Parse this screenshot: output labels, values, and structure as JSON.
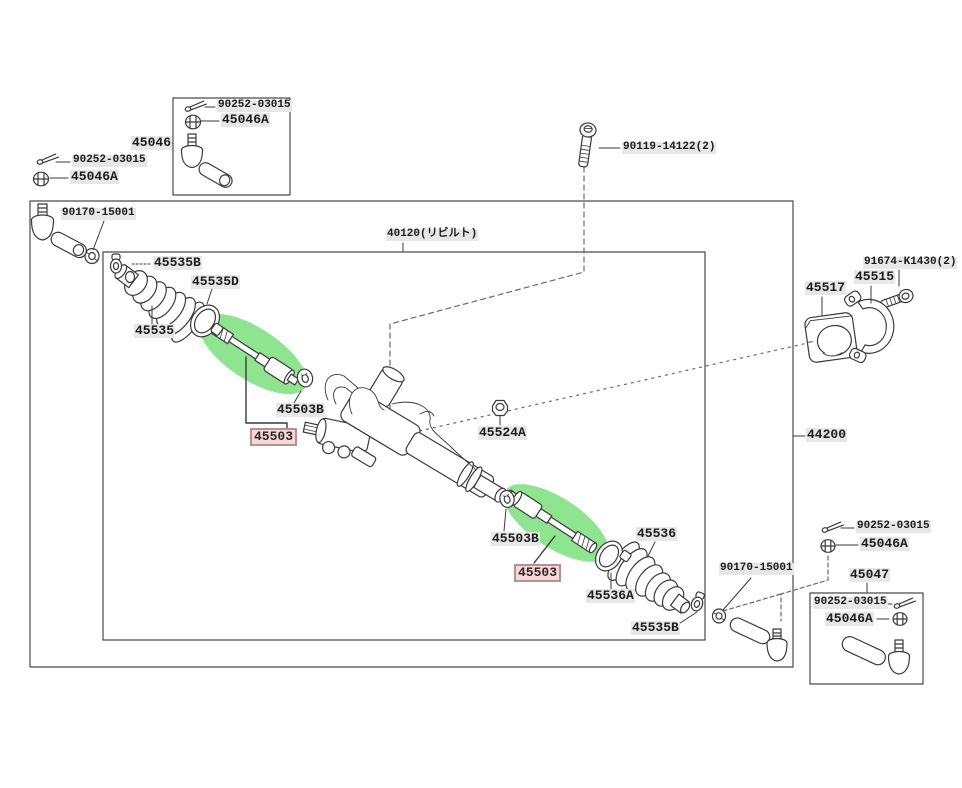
{
  "diagram": {
    "type": "exploded-parts-diagram",
    "subject": "steering gear and linkage",
    "highlight_color": "#8fe48f",
    "highlight_label_bg": "#f3d9d9",
    "highlight_label_border": "#b99090",
    "labels": {
      "tl_pin": "90252-03015",
      "tl_nut": "45046A",
      "t45046": "45046",
      "b46_pin": "90252-03015",
      "b46_nut": "45046A",
      "bolt90119": "90119-14122(2)",
      "nut_left": "90170-15001",
      "rack40120": "40120(リビルト)",
      "l45535B": "45535B",
      "l45535D": "45535D",
      "l45535": "45535",
      "l45503B_l": "45503B",
      "l45503_l": "45503",
      "l45524A": "45524A",
      "l45503B_r": "45503B",
      "l45503_r": "45503",
      "l45536": "45536",
      "l45536A": "45536A",
      "l45535B_r": "45535B",
      "l44200": "44200",
      "l45517": "45517",
      "l45515": "45515",
      "l91674": "91674-K1430(2)",
      "br_pin": "90252-03015",
      "br_nut": "45046A",
      "nut_bottom": "90170-15001",
      "l45047": "45047",
      "b47_pin": "90252-03015",
      "b47_nut": "45046A"
    }
  }
}
